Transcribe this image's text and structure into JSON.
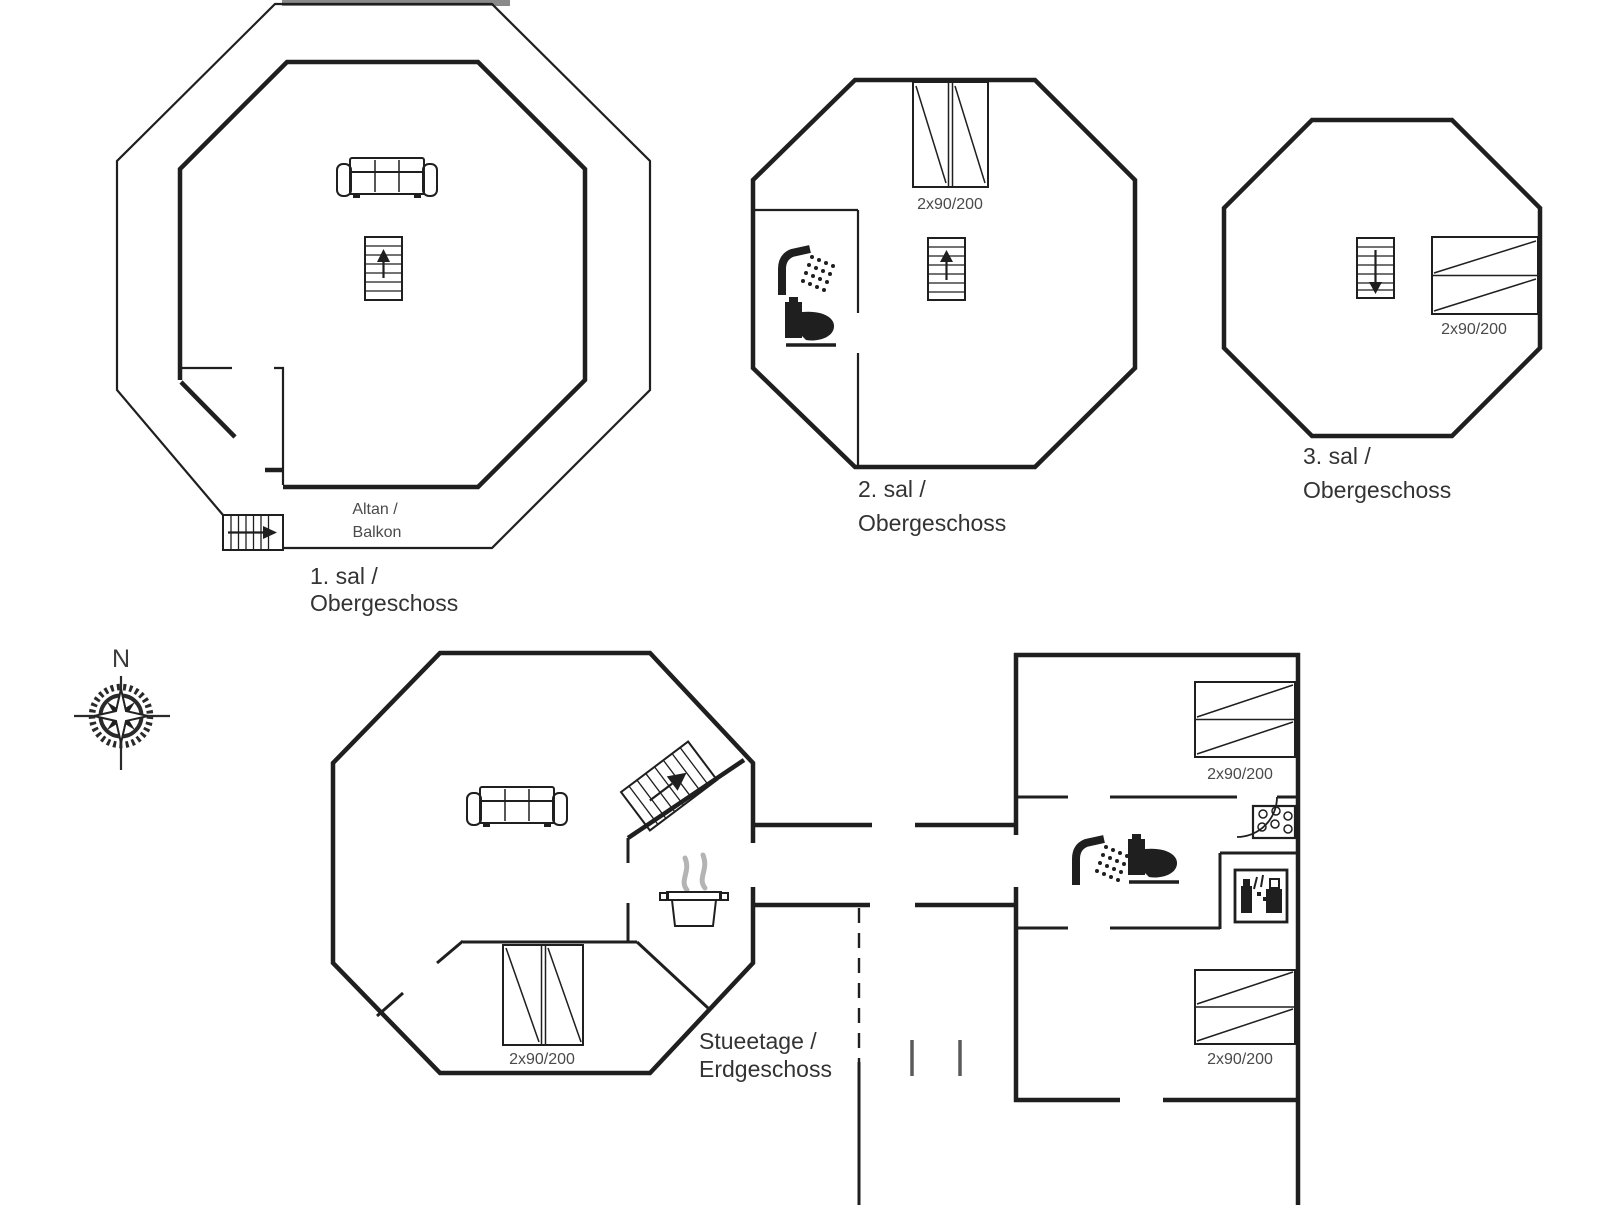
{
  "document": {
    "type": "floor-plan",
    "building": "octagonal holiday home"
  },
  "colors": {
    "line": "#1f1f1f",
    "text": "#333333",
    "muted": "#4a4a4a",
    "steam": "#b4b4b4",
    "background": "#ffffff"
  },
  "compass": {
    "north_label": "N"
  },
  "floors": {
    "first": {
      "label_line1": "1. sal /",
      "label_line2": "Obergeschoss",
      "balcony_line1": "Altan /",
      "balcony_line2": "Balkon"
    },
    "second": {
      "label_line1": "2. sal /",
      "label_line2": "Obergeschoss",
      "bed_size": "2x90/200"
    },
    "third": {
      "label_line1": "3. sal /",
      "label_line2": "Obergeschoss",
      "bed_size": "2x90/200"
    },
    "ground": {
      "label_line1": "Stueetage /",
      "label_line2": "Erdgeschoss",
      "bed_size_livingroom": "2x90/200",
      "bed_size_annex_top": "2x90/200",
      "bed_size_annex_bottom": "2x90/200"
    }
  },
  "icons": [
    "sofa-icon",
    "staircase-up-icon",
    "staircase-down-icon",
    "external-staircase-icon",
    "diagonal-staircase-icon",
    "double-bed-icon",
    "shower-icon",
    "toilet-icon",
    "washbasin-icon",
    "washing-machine-icon",
    "cooking-pot-icon",
    "compass-rose-icon",
    "door-swing-arc"
  ]
}
